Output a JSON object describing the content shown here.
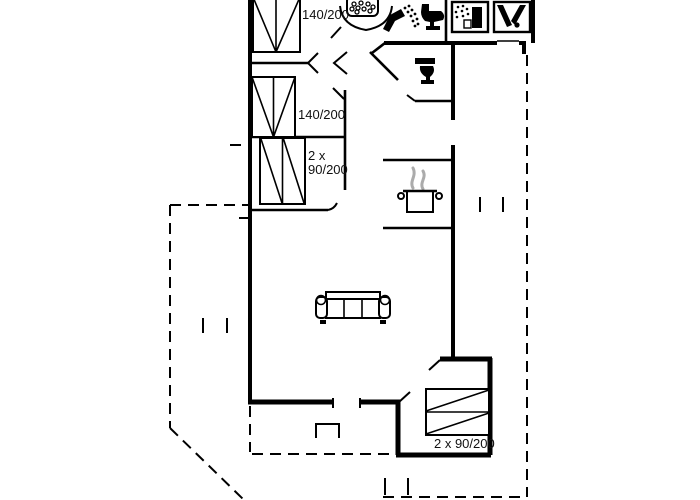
{
  "meta": {
    "description": "Black-and-white architectural floor plan of a holiday home with bedrooms, bathroom, WC, kitchen, living room, annex room and dashed terrace outlines",
    "width": 700,
    "height": 500
  },
  "colors": {
    "background": "#ffffff",
    "line": "#000000",
    "steam": "#ababab",
    "text": "#111111"
  },
  "labels": {
    "bed_top": "140/200",
    "bed_middle": "140/200",
    "bed_lower_line1": "2 x",
    "bed_lower_line2": "90/200",
    "bed_annex": "2 x 90/200"
  },
  "icons": [
    {
      "name": "shower-head-icon",
      "meaning": "overhead shower in corner shower cabin"
    },
    {
      "name": "hand-shower-icon",
      "meaning": "hand shower with spray"
    },
    {
      "name": "toilet-icon",
      "meaning": "toilet, bathroom"
    },
    {
      "name": "toilet-icon",
      "meaning": "toilet, separate WC"
    },
    {
      "name": "dishwasher-icon",
      "meaning": "appliance with spray"
    },
    {
      "name": "washing-machine-icon",
      "meaning": "appliance with drum"
    },
    {
      "name": "cooking-pot-icon",
      "meaning": "kitchen / stove"
    },
    {
      "name": "sofa-icon",
      "meaning": "living room sofa"
    },
    {
      "name": "double-bed-icon",
      "meaning": "140 cm double bed"
    },
    {
      "name": "double-bed-icon",
      "meaning": "140 cm double bed"
    },
    {
      "name": "twin-bed-icon",
      "meaning": "2 x 90 cm beds"
    },
    {
      "name": "bunk-bed-icon",
      "meaning": "2 x 90 cm beds in annex"
    }
  ]
}
